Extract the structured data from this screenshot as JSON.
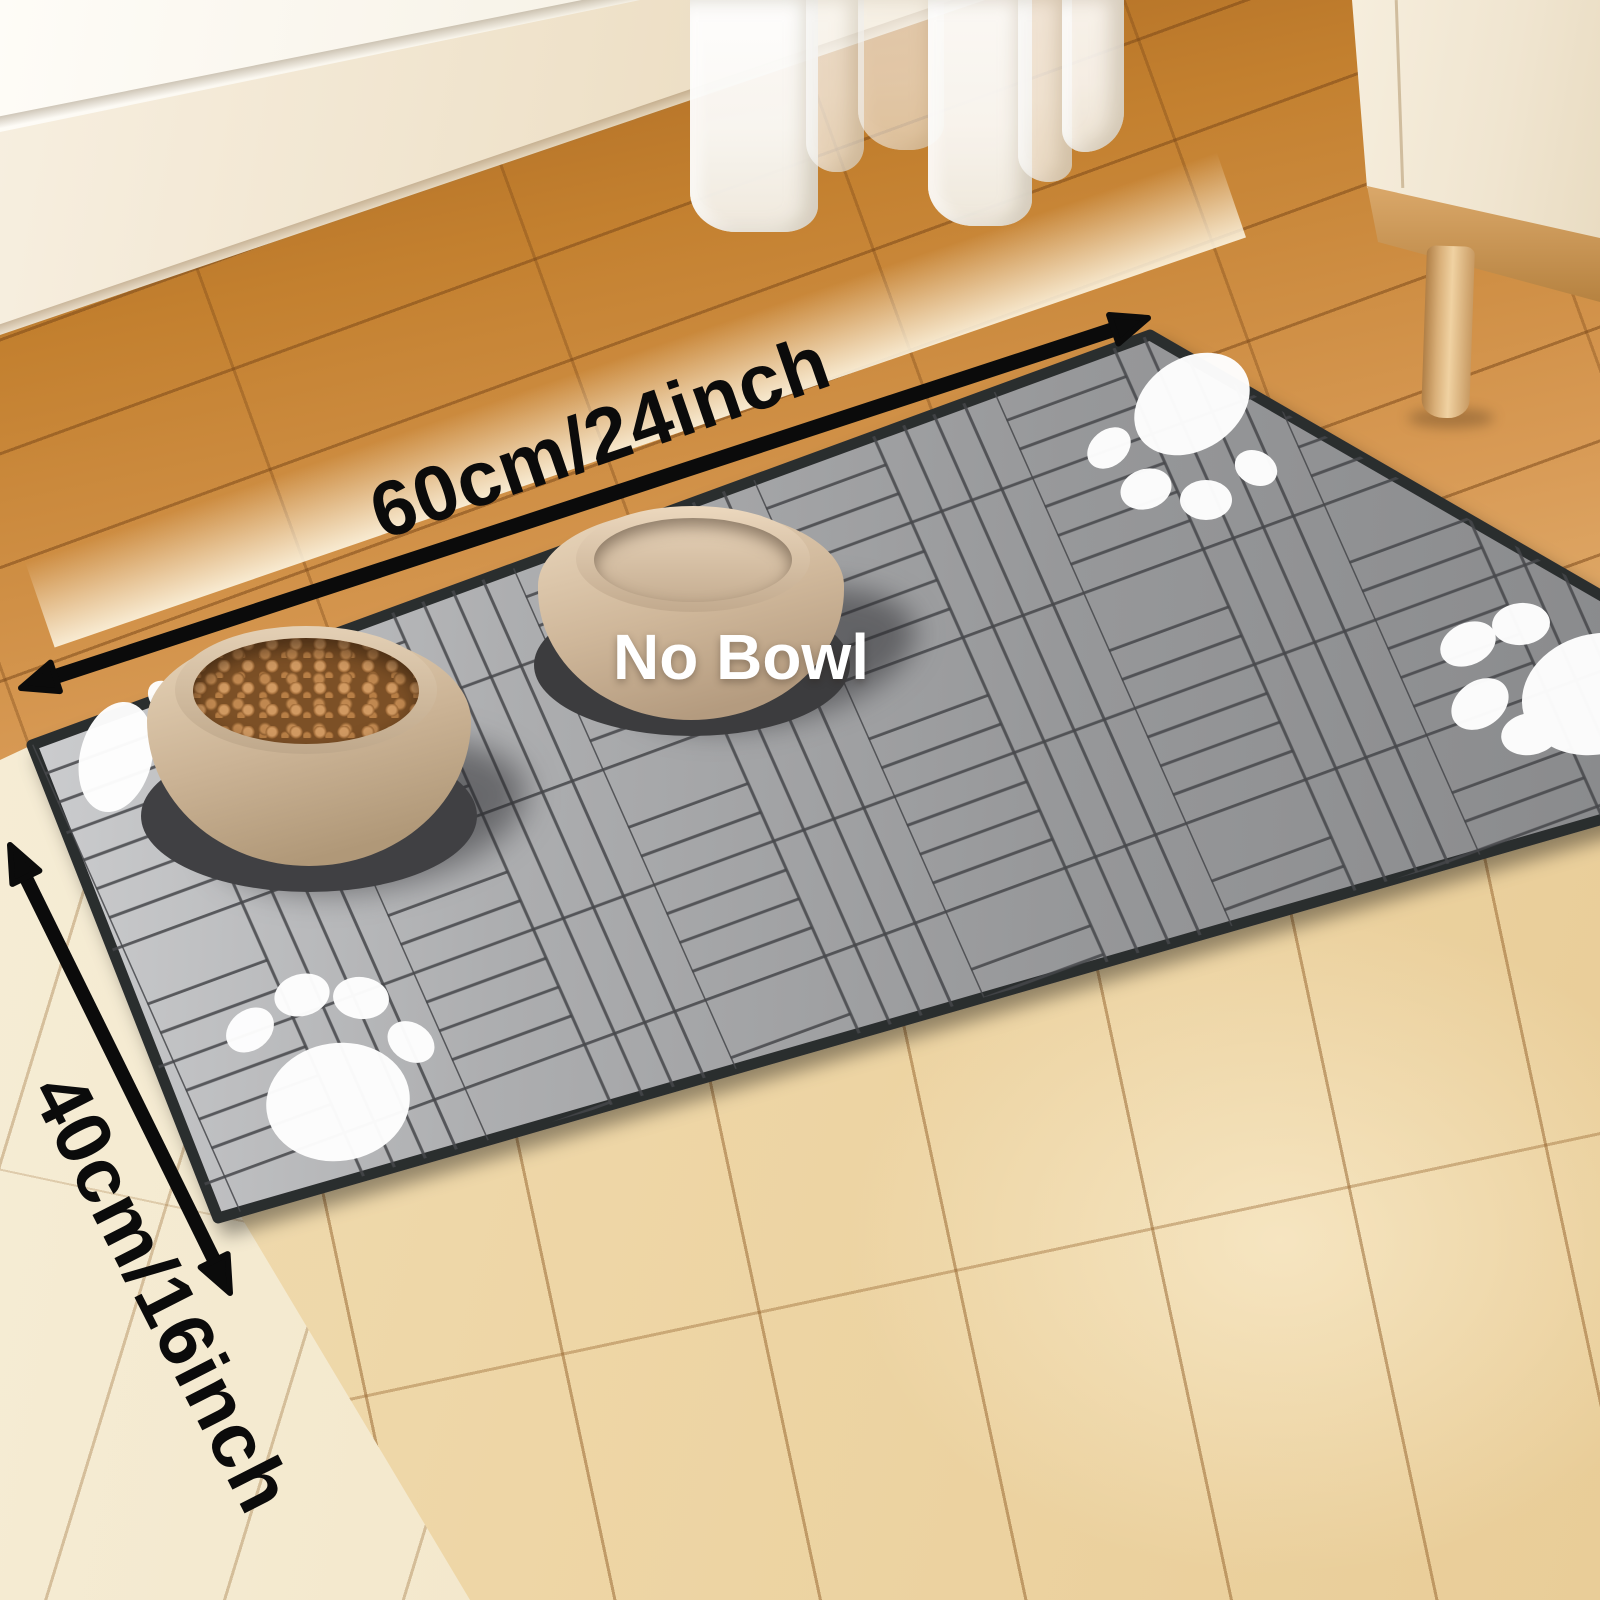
{
  "annotations": {
    "width_label": "60cm/24inch",
    "height_label": "40cm/16inch",
    "no_bowl_label": "No Bowl",
    "arrow_color": "#0b0b0b",
    "dimension_text_color": "#0b0b0b",
    "no_bowl_text_color": "#ffffff"
  },
  "mat": {
    "type": "pet feeding mat",
    "pattern": "herringbone",
    "surface_color_light": "#c9cacb",
    "surface_color_mid": "#a7a8aa",
    "surface_color_dark": "#8a8b8d",
    "pattern_line_color": "#46474a",
    "border_color": "#2c2d2f",
    "paw_print_color": "#ffffff",
    "paw_print_count": 4
  },
  "bowls": [
    {
      "id": "food-bowl",
      "contents": "kibble",
      "bowl_color": "#cdb79c",
      "kibble_color": "#a9713d"
    },
    {
      "id": "water-bowl",
      "contents": "water",
      "bowl_color": "#cdb79c"
    }
  ],
  "room": {
    "wall_color": "#f1e5cf",
    "sill_color": "#fcfaf3",
    "curtain_color": "#f7f5f0",
    "cabinet_color": "#f1e7d4",
    "cabinet_leg_color": "#d9af78",
    "floor_wood_warm": "#c98845",
    "floor_wood_pale": "#eed7a8",
    "floor_wood_cream": "#f3e9cf"
  }
}
